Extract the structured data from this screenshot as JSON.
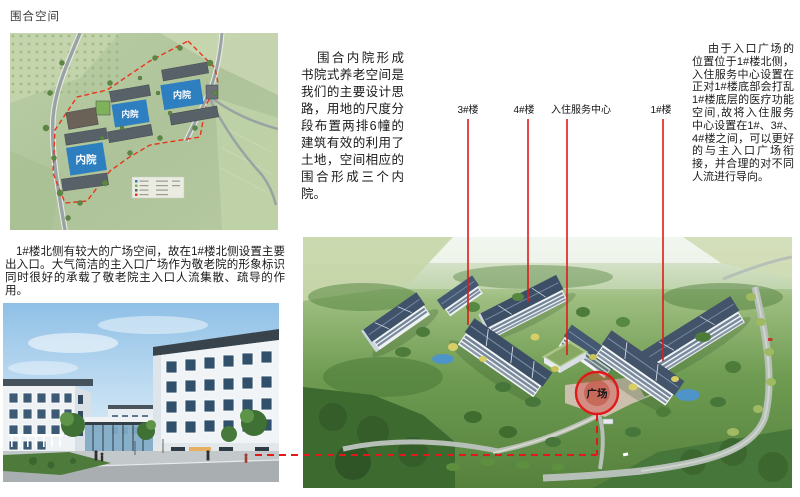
{
  "page": {
    "title": "围合空间"
  },
  "colors": {
    "annotation_red": "#e01a1a",
    "courtyard_blue": "#2e7fc0",
    "plaza_circle_fill": "rgba(220,40,40,0.32)"
  },
  "sections": {
    "site_plan": {
      "courtyard_labels": [
        "内院",
        "内院",
        "内院"
      ]
    },
    "courtyard_text": "围合内院形成书院式养老空间是我们的主要设计思路，用地的尺度分段布置两排6幢的建筑有效的利用了土地，空间相应的围合形成三个内院。",
    "service_center_text": "由于入口广场的位置位于1#楼北侧，入住服务中心设置在正对1#楼底部会打乱1#楼底层的医疗功能空间,故将入住服务中心设置在1#、3#、4#楼之间，可以更好的与主入口广场衔接，并合理的对不同人流进行导向。",
    "plaza_text": "1#楼北侧有较大的广场空间，故在1#楼北侧设置主要出入口。大气简洁的主入口广场作为敬老院的形象标识同时很好的承载了敬老院主入口人流集散、疏导的作用。",
    "callouts": [
      {
        "label": "3#楼"
      },
      {
        "label": "4#楼"
      },
      {
        "label": "入住服务中心"
      },
      {
        "label": "1#楼"
      }
    ],
    "aerial": {
      "plaza_label": "广场"
    }
  }
}
